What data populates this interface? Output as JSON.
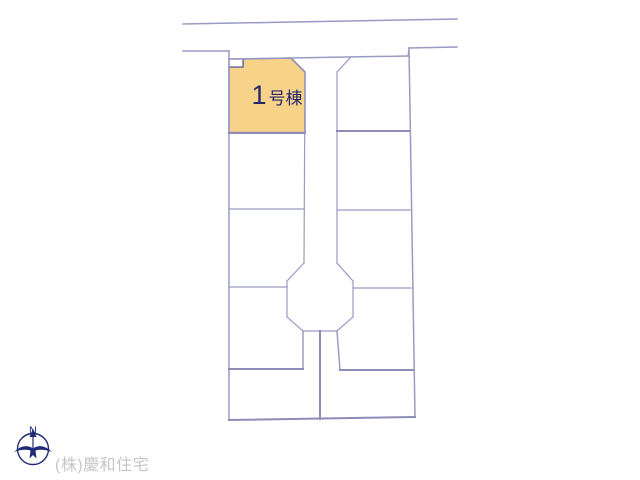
{
  "site_plan": {
    "highlighted_plot": {
      "number": "1",
      "suffix": "号棟",
      "fill_color": "#F6D389",
      "label_color": "#26266B"
    },
    "compass": {
      "north_label": "N",
      "color": "#1F2B78"
    },
    "watermark": {
      "text": "(株)慶和住宅",
      "color": "#C6C6C6"
    },
    "lines": {
      "thin_color": "#9A9AC4",
      "strong_color": "#8C8CB6"
    },
    "background": "#FFFFFF"
  }
}
